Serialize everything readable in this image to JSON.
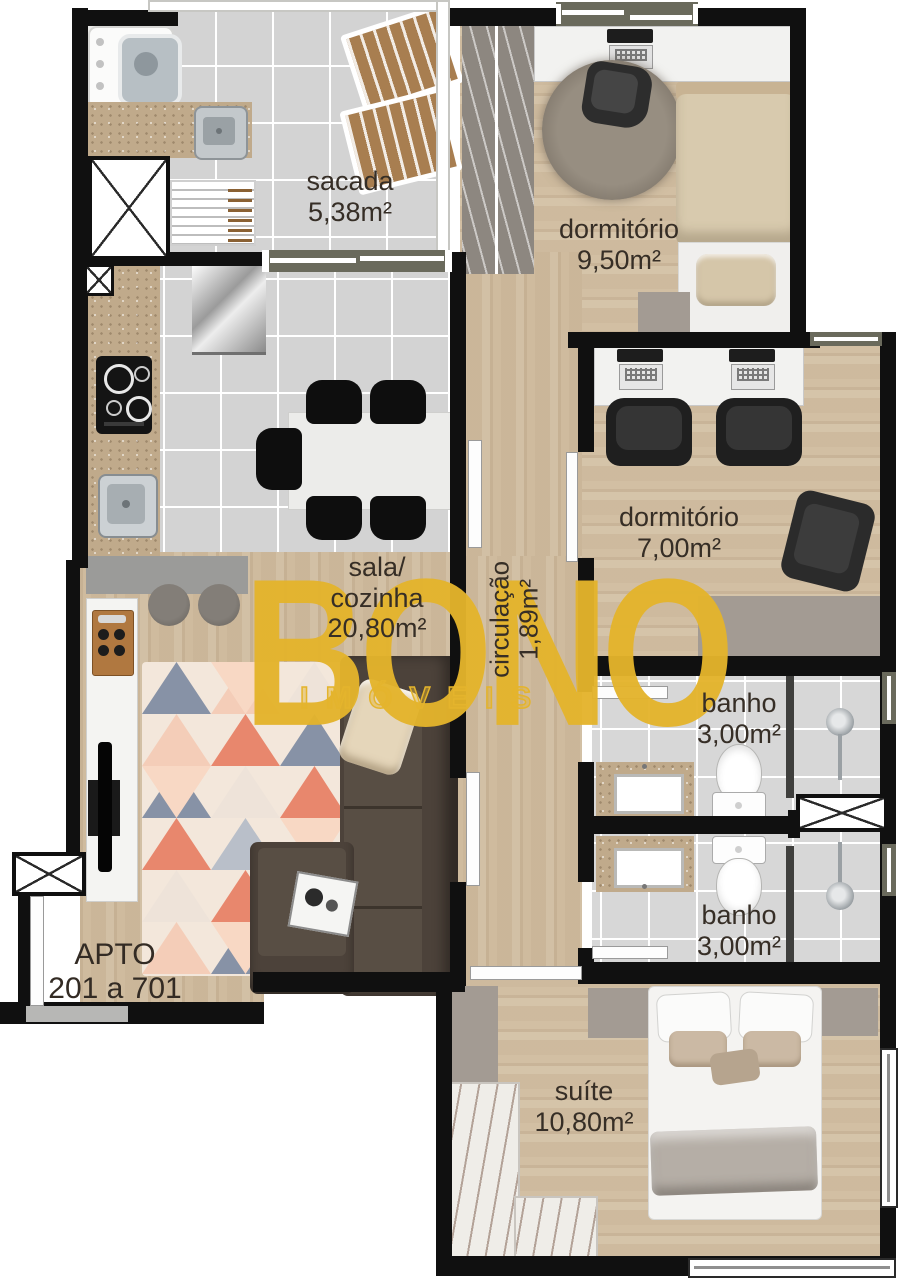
{
  "plan": {
    "apartment": {
      "line1": "APTO",
      "line2": "201 a 701"
    },
    "watermark": {
      "brand": "BONO",
      "subtitle": "IMÓVEIS",
      "color": "#E4B42C"
    },
    "rooms": {
      "sacada": {
        "name": "sacada",
        "area": "5,38m²"
      },
      "dormitorio1": {
        "name": "dormitório",
        "area": "9,50m²"
      },
      "dormitorio2": {
        "name": "dormitório",
        "area": "7,00m²"
      },
      "sala_cozinha": {
        "name_line1": "sala/",
        "name_line2": "cozinha",
        "area": "20,80m²"
      },
      "circulacao": {
        "name": "circulação",
        "area": "1,89m²"
      },
      "banho_superior": {
        "name": "banho",
        "area": "3,00m²"
      },
      "banho_inferior": {
        "name": "banho",
        "area": "3,00m²"
      },
      "suite": {
        "name": "suíte",
        "area": "10,80m²"
      }
    }
  }
}
